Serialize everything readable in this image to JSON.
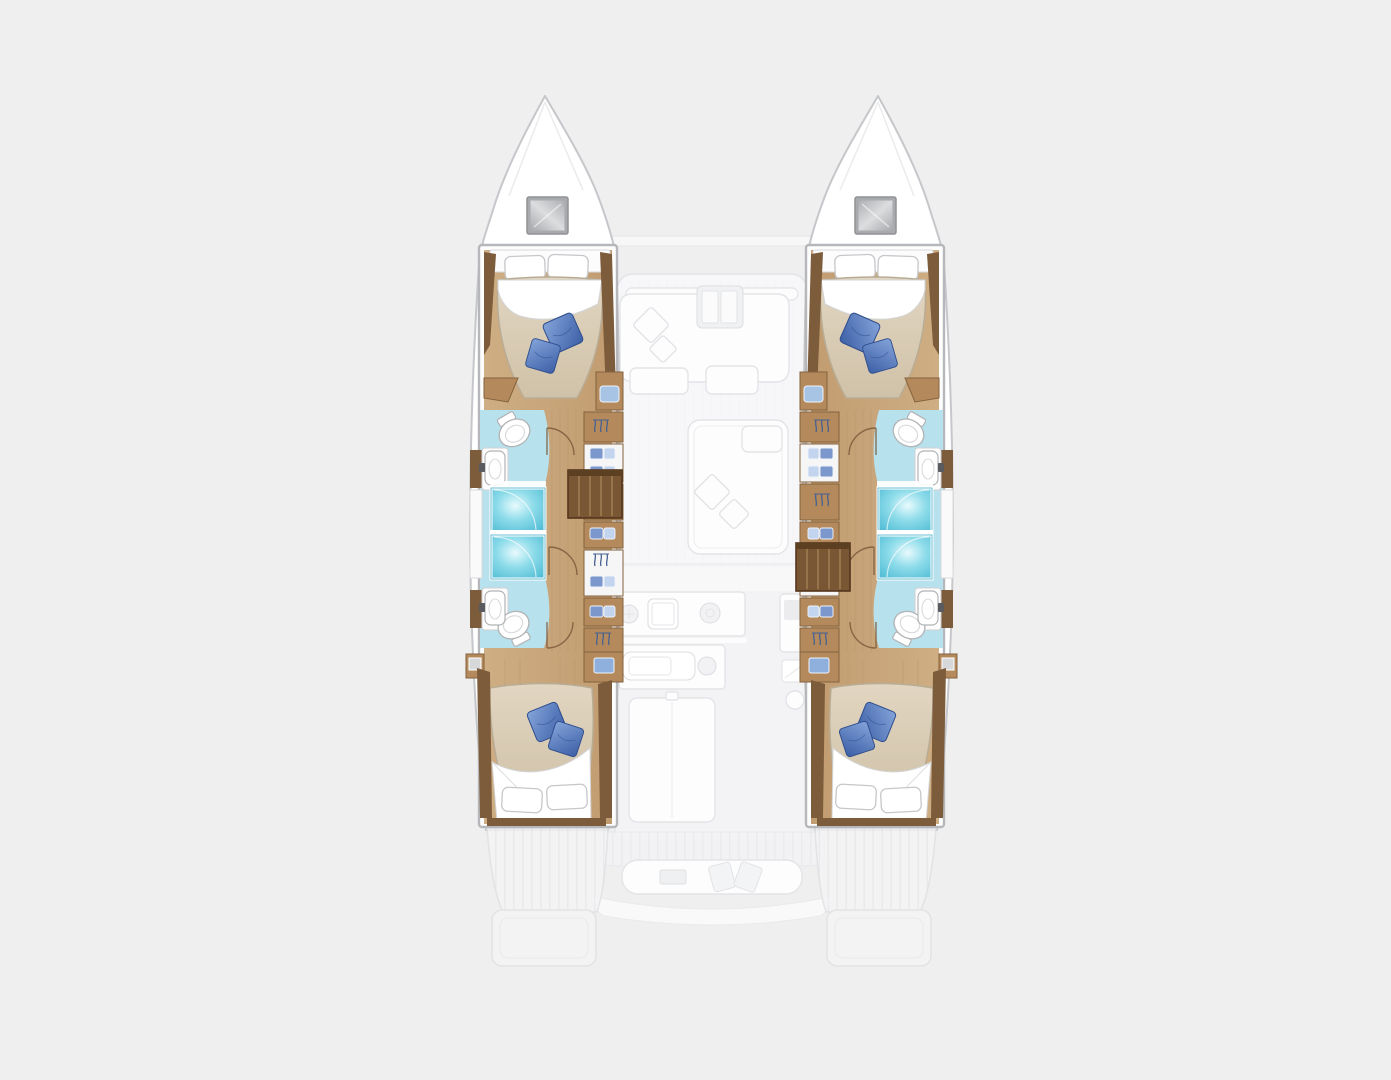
{
  "colors": {
    "background": "#efeff0",
    "hull_white": "#ffffff",
    "outline_gray": "#c6c7ca",
    "frame_gray": "#b6b7ba",
    "wood_floor": "#c9a87e",
    "wood_trim": "#7d5c3c",
    "wood_cabinet": "#b48a5d",
    "wood_cabinet_border": "#85613c",
    "stairs_wood": "#7a5734",
    "stairs_tread": "#9e7b50",
    "mattress": "#dbcfba",
    "mattress_border": "#b9ac95",
    "pillow_white": "#ffffff",
    "pillow_blue": "#5b82c6",
    "pillow_blue_dark": "#35549c",
    "bath_floor": "#b7e1ec",
    "shower_fill": "#5ec7dc",
    "hatch_gray": "#a9aaad",
    "fixture_stroke": "#b2b3b6",
    "faded_fill": "#f8f8fa",
    "faded_item": "#fdfdfe",
    "faded_stroke": "#e3e4e7"
  },
  "scene": {
    "type": "catamaran-yacht-floorplan",
    "view": "top-down",
    "render_style": {
      "lower_deck_hulls": "full-color",
      "main_deck_overlay": "faded"
    },
    "port_hull": {
      "bow_features": [
        "deck-hatch"
      ],
      "rooms": [
        {
          "name": "forward-cabin",
          "furniture": [
            "double-bed",
            "2 white pillows",
            "2 blue cushions",
            "headboard-shelf"
          ]
        },
        {
          "name": "forward-bathroom",
          "fixtures": [
            "toilet",
            "washbasin",
            "shower-stall"
          ]
        },
        {
          "name": "aft-bathroom",
          "fixtures": [
            "toilet",
            "washbasin",
            "shower-stall"
          ]
        },
        {
          "name": "wardrobe-lockers",
          "icons": [
            "hanging-clothes",
            "folded-clothes"
          ]
        },
        {
          "name": "companionway-stairs",
          "steps": 5
        },
        {
          "name": "aft-cabin",
          "furniture": [
            "double-bed",
            "2 white pillows",
            "2 blue cushions",
            "nightstand",
            "locker"
          ]
        }
      ],
      "stern_features": [
        "teak-deck",
        "swim-step"
      ]
    },
    "starboard_hull": {
      "mirror_of": "port_hull",
      "difference": "companionway stairs located further aft"
    },
    "main_deck_faded": {
      "areas": [
        {
          "name": "foredeck-crossbeam",
          "items": []
        },
        {
          "name": "saloon",
          "items": [
            "u-shaped-sofa",
            "table",
            "2 diamond cushions",
            "chaise-lounge"
          ]
        },
        {
          "name": "galley",
          "items": [
            "sink",
            "burners",
            "counter",
            "island-unit"
          ]
        },
        {
          "name": "helm-station",
          "items": [
            "console",
            "screen",
            "seat"
          ]
        },
        {
          "name": "cockpit",
          "items": [
            "teak-sole",
            "aft-bench",
            "table"
          ]
        },
        {
          "name": "transom",
          "items": [
            "swim-platforms",
            "steps"
          ]
        }
      ]
    }
  }
}
